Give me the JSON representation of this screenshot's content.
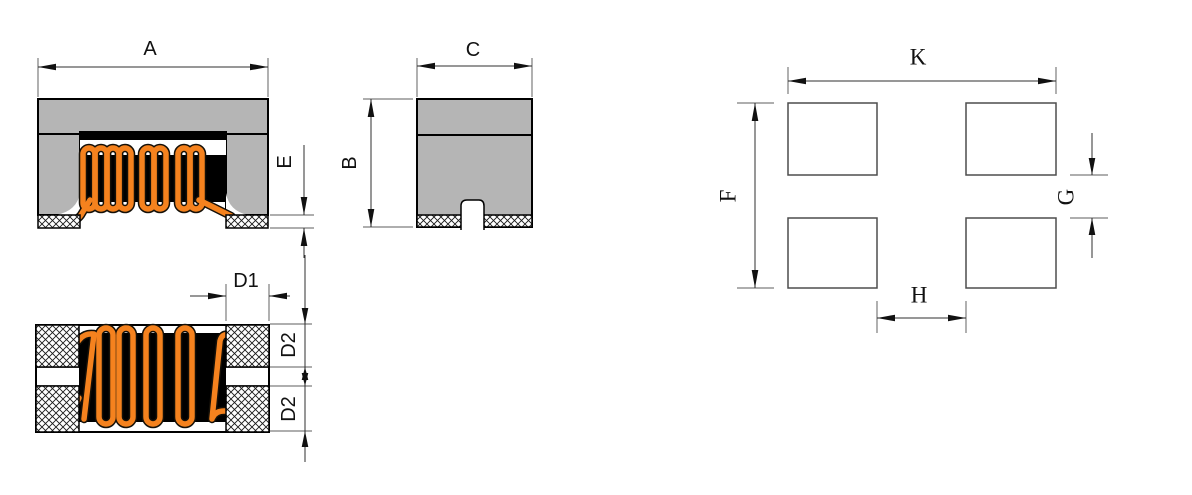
{
  "title": "SMD common mode choke inductor dimension drawing",
  "colors": {
    "body_gray": "#b5b5b5",
    "wire_orange": "#F5821E",
    "core_black": "#000000",
    "line_dark": "#2f2f2f"
  },
  "labels": {
    "front": {
      "a": "A",
      "e": "E"
    },
    "side": {
      "c": "C",
      "b": "B"
    },
    "bottom": {
      "d1": "D1",
      "d2_upper": "D2",
      "d2_lower": "D2"
    },
    "land": {
      "k": "K",
      "f": "F",
      "g": "G",
      "h": "H"
    }
  }
}
